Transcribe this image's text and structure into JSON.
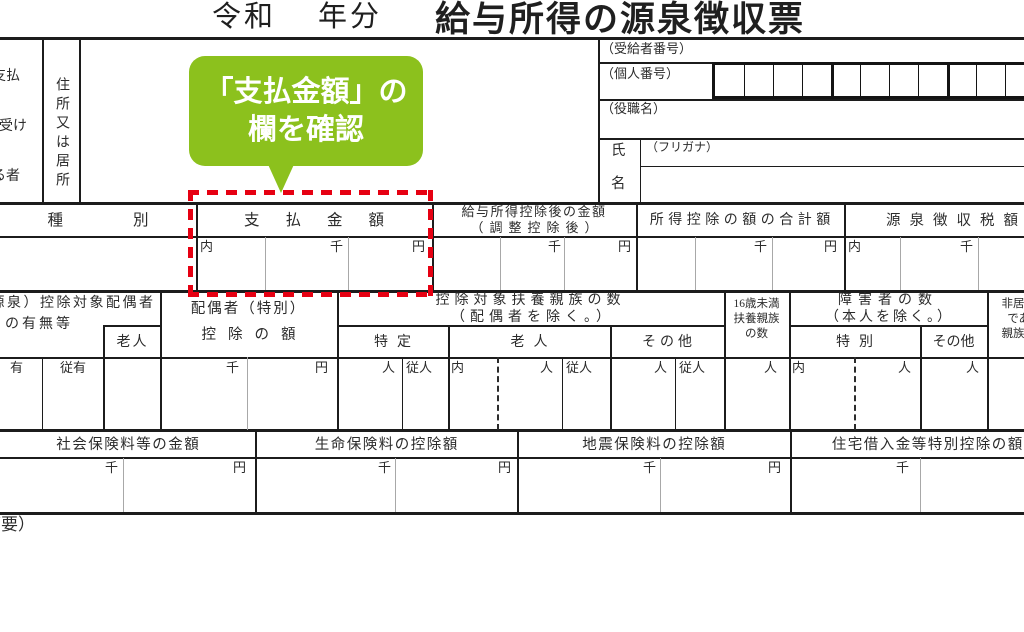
{
  "title": {
    "era": "令和",
    "nenbun": "年分",
    "main": "給与所得の源泉徴収票"
  },
  "payer_block": {
    "payer_l1": "支払",
    "payer_l2": "を受け",
    "payer_l3": "る者",
    "address": "住所又は居所"
  },
  "recipient_panel": {
    "jukyusha_no": "（受給者番号）",
    "kojin_no": "（個人番号）",
    "yakushoku": "（役職名）",
    "shi": "氏",
    "mei": "名",
    "furigana": "（フリガナ）"
  },
  "callout": {
    "line1": "「支払金額」の",
    "line2": "欄を確認"
  },
  "band_a": {
    "shubetsu": "種別",
    "shiharai_kingaku": "支払金額",
    "kyuyo_l1": "給与所得控除後の金額",
    "kyuyo_l2": "（調整控除後）",
    "shotoku_gokei": "所得控除の額の合計額",
    "gensen_zeigaku": "源泉徴収税額"
  },
  "band_b": {
    "haigusha_umu_l1": "（源泉）控除対象配偶者",
    "haigusha_umu_l2": "の有無等",
    "rojin_small": "老人",
    "haigusha_l1": "配偶者（特別）",
    "haigusha_l2": "控除の額",
    "fuyo_l1": "控除対象扶養親族の数",
    "fuyo_l2": "（配偶者を除く。）",
    "tokutei": "特定",
    "rojin": "老人",
    "sonota": "その他",
    "u16_l1": "16歳未満",
    "u16_l2": "扶養親族",
    "u16_l3": "の数",
    "shogai_l1": "障害者の数",
    "shogai_l2": "（本人を除く。）",
    "tokubetsu": "特別",
    "sonota2": "その他",
    "hikyoju_l1": "非居住者",
    "hikyoju_l2": "である",
    "hikyoju_l3": "親族の数"
  },
  "band_c": {
    "shakai": "社会保険料等の金額",
    "seimei": "生命保険料の控除額",
    "jishin": "地震保険料の控除額",
    "jutaku": "住宅借入金等特別控除の額"
  },
  "units": {
    "sen": "千",
    "en": "円",
    "uchi": "内",
    "nin": "人",
    "junin": "従人",
    "yu": "有",
    "juyu": "従有"
  },
  "notes": {
    "tekiyo": "（摘要）"
  },
  "colors": {
    "callout_green": "#8cc11d",
    "highlight_red": "#e60012"
  }
}
